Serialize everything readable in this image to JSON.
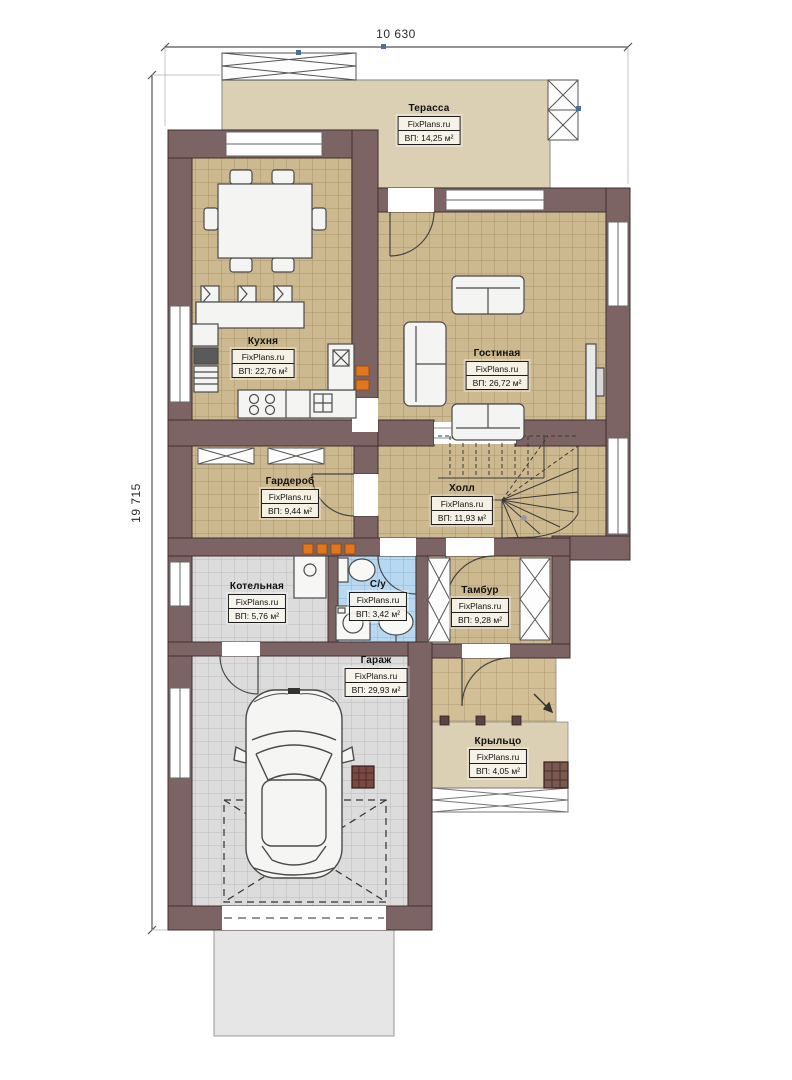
{
  "title": "План первого этажа",
  "brand": "FixPlans.ru",
  "dimensions": {
    "width": "10 630",
    "height": "19 715"
  },
  "rooms": [
    {
      "id": "terrace",
      "name": "Терасса",
      "brand": "FixPlans.ru",
      "area": "ВП: 14,25 м²"
    },
    {
      "id": "kitchen",
      "name": "Кухня",
      "brand": "FixPlans.ru",
      "area": "ВП: 22,76 м²"
    },
    {
      "id": "living",
      "name": "Гостиная",
      "brand": "FixPlans.ru",
      "area": "ВП: 26,72 м²"
    },
    {
      "id": "wardrobe",
      "name": "Гардероб",
      "brand": "FixPlans.ru",
      "area": "ВП: 9,44 м²"
    },
    {
      "id": "hall",
      "name": "Холл",
      "brand": "FixPlans.ru",
      "area": "ВП: 11,93 м²"
    },
    {
      "id": "boiler",
      "name": "Котельная",
      "brand": "FixPlans.ru",
      "area": "ВП: 5,76 м²"
    },
    {
      "id": "wc",
      "name": "С/у",
      "brand": "FixPlans.ru",
      "area": "ВП: 3,42 м²"
    },
    {
      "id": "tambour",
      "name": "Тамбур",
      "brand": "FixPlans.ru",
      "area": "ВП: 9,28 м²"
    },
    {
      "id": "garage",
      "name": "Гараж",
      "brand": "FixPlans.ru",
      "area": "ВП: 29,93 м²"
    },
    {
      "id": "porch",
      "name": "Крыльцо",
      "brand": "FixPlans.ru",
      "area": "ВП: 4,05 м²"
    }
  ],
  "colors": {
    "wall": "#7c6464",
    "wall_stroke": "#402f2f",
    "floor_tan": "#cdb98f",
    "floor_tan_grid": "#ab9468",
    "terrace": "#dbcfb4",
    "floor_grey": "#dcdcdc",
    "floor_blue": "#b7d8f1",
    "accent_orange": "#e2761d",
    "car_body": "#f5f5f3",
    "apron": "#e6e6e6"
  }
}
